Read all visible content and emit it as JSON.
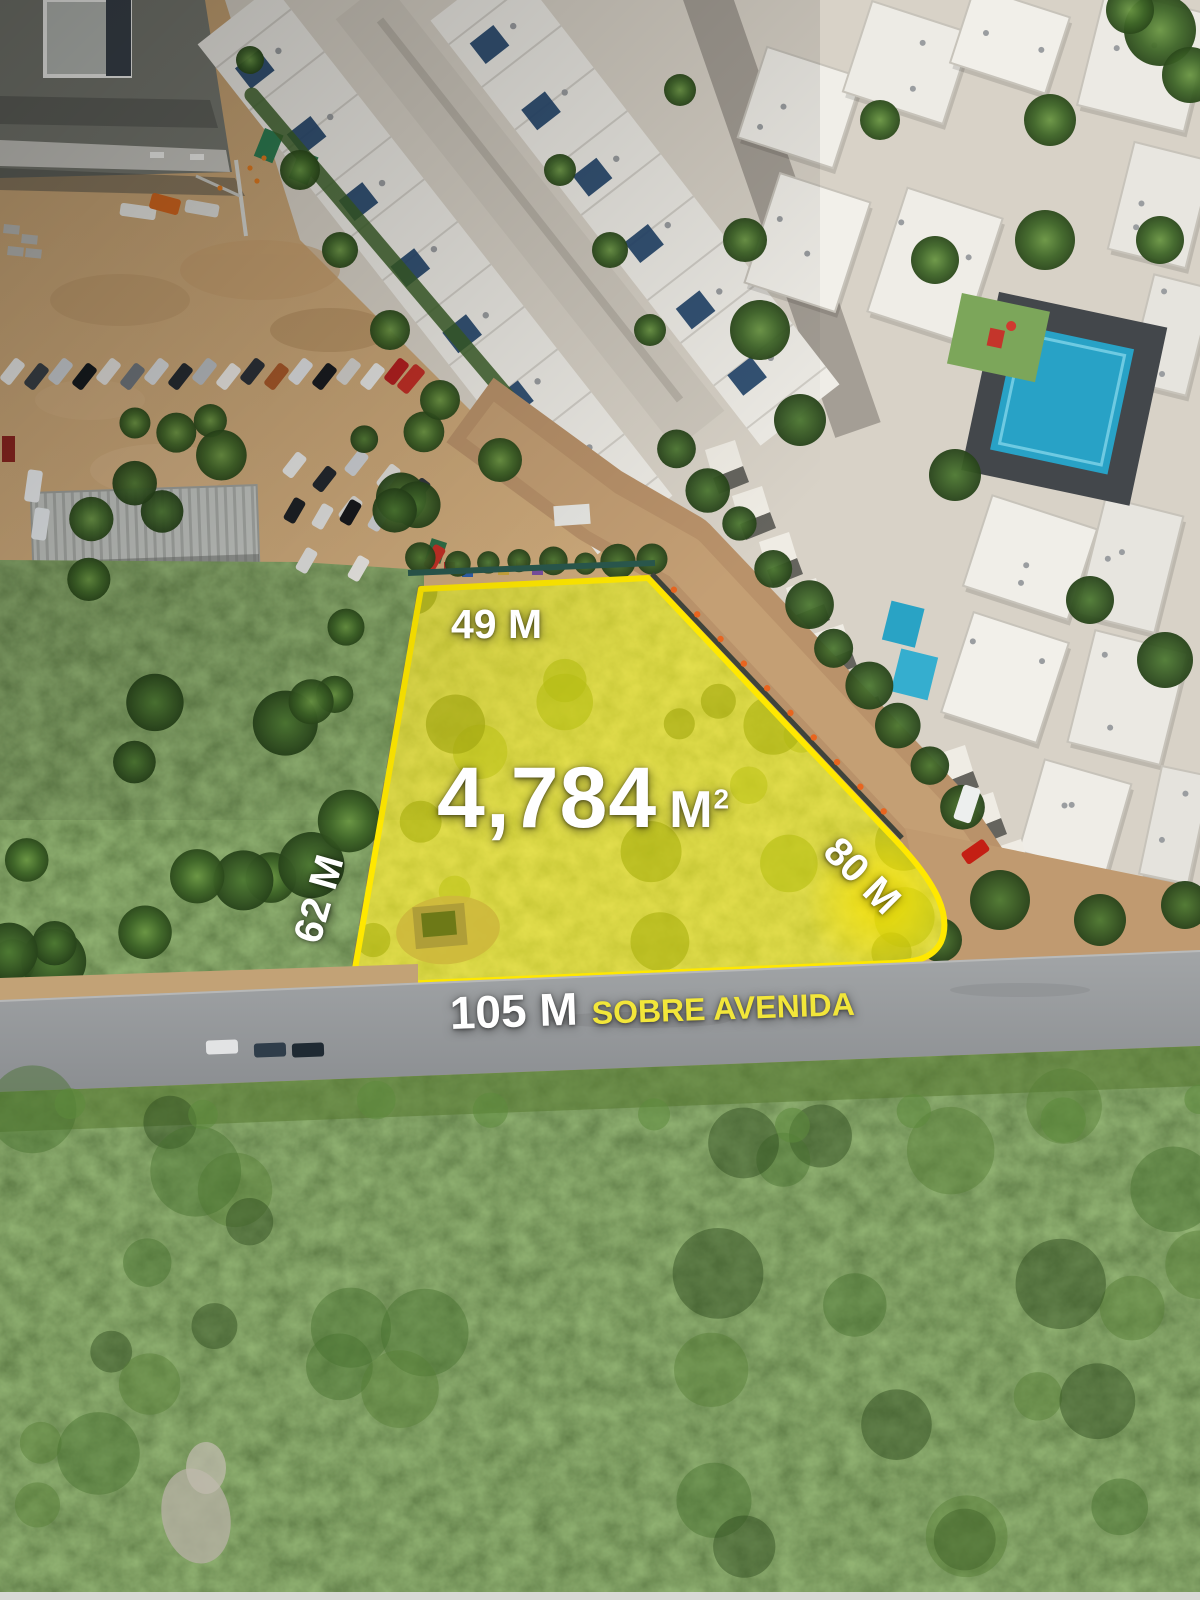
{
  "plot": {
    "area_value": "4,784",
    "area_unit_base": "M",
    "area_unit_sup": "2",
    "top_dimension": "49 M",
    "left_dimension": "62 M",
    "right_dimension": "80 M",
    "frontage_dimension": "105 M",
    "frontage_note": "SOBRE AVENIDA"
  },
  "colors": {
    "boundary_yellow": "#FFE800",
    "note_yellow": "#F2E63A",
    "label_white": "#FFFFFF"
  }
}
